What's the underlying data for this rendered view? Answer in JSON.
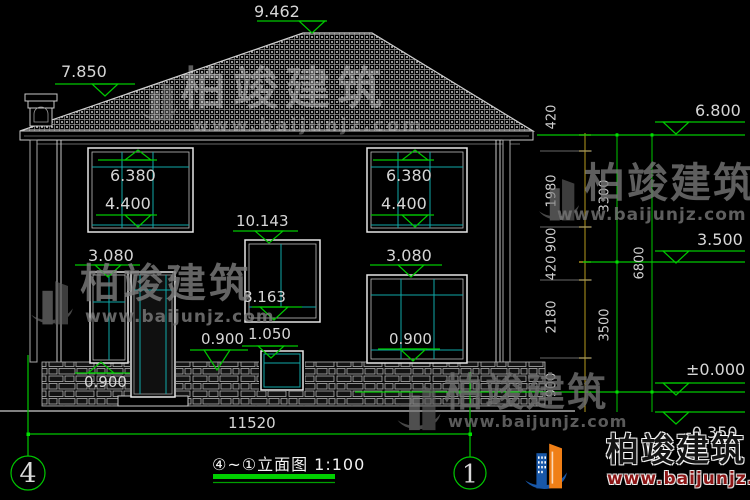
{
  "title": {
    "text": "④~①立面图 1:100"
  },
  "axis": {
    "left": "4",
    "right": "1"
  },
  "dims": {
    "overall": "11520",
    "chain1": [
      "420",
      "1980",
      "900",
      "420",
      "2180",
      "900"
    ],
    "chain2": [
      "3300",
      "3500"
    ],
    "chain3": "6800"
  },
  "levels": {
    "ridge": "9.462",
    "chimney": "7.850",
    "eave": "6.800",
    "mid": "3.500",
    "ground": "±0.000",
    "outdoor": "-0.350"
  },
  "windows": {
    "upper_left_top": "6.380",
    "upper_left_bottom": "4.400",
    "upper_right_top": "6.380",
    "upper_right_bottom": "4.400",
    "stair_top": "10.143",
    "stair_bottom": "8.163",
    "lower_left_top": "3.080",
    "lower_left_bottom": "0.900",
    "lower_right_top": "3.080",
    "lower_right_bottom": "0.900",
    "center_small_top": "1.050",
    "porch_level": "0.900"
  },
  "watermark": {
    "brand": "柏竣建筑",
    "url": "www.baijunjz.com"
  },
  "colors": {
    "dimension_green": "#00c800",
    "mullion_teal": "#0fa8a8",
    "chain_yellow": "#b69a1e",
    "line_white": "#c8c8c8",
    "logo_blue": "#1857a8",
    "logo_orange": "#f07f16",
    "corner_url_red": "#8c1616"
  }
}
